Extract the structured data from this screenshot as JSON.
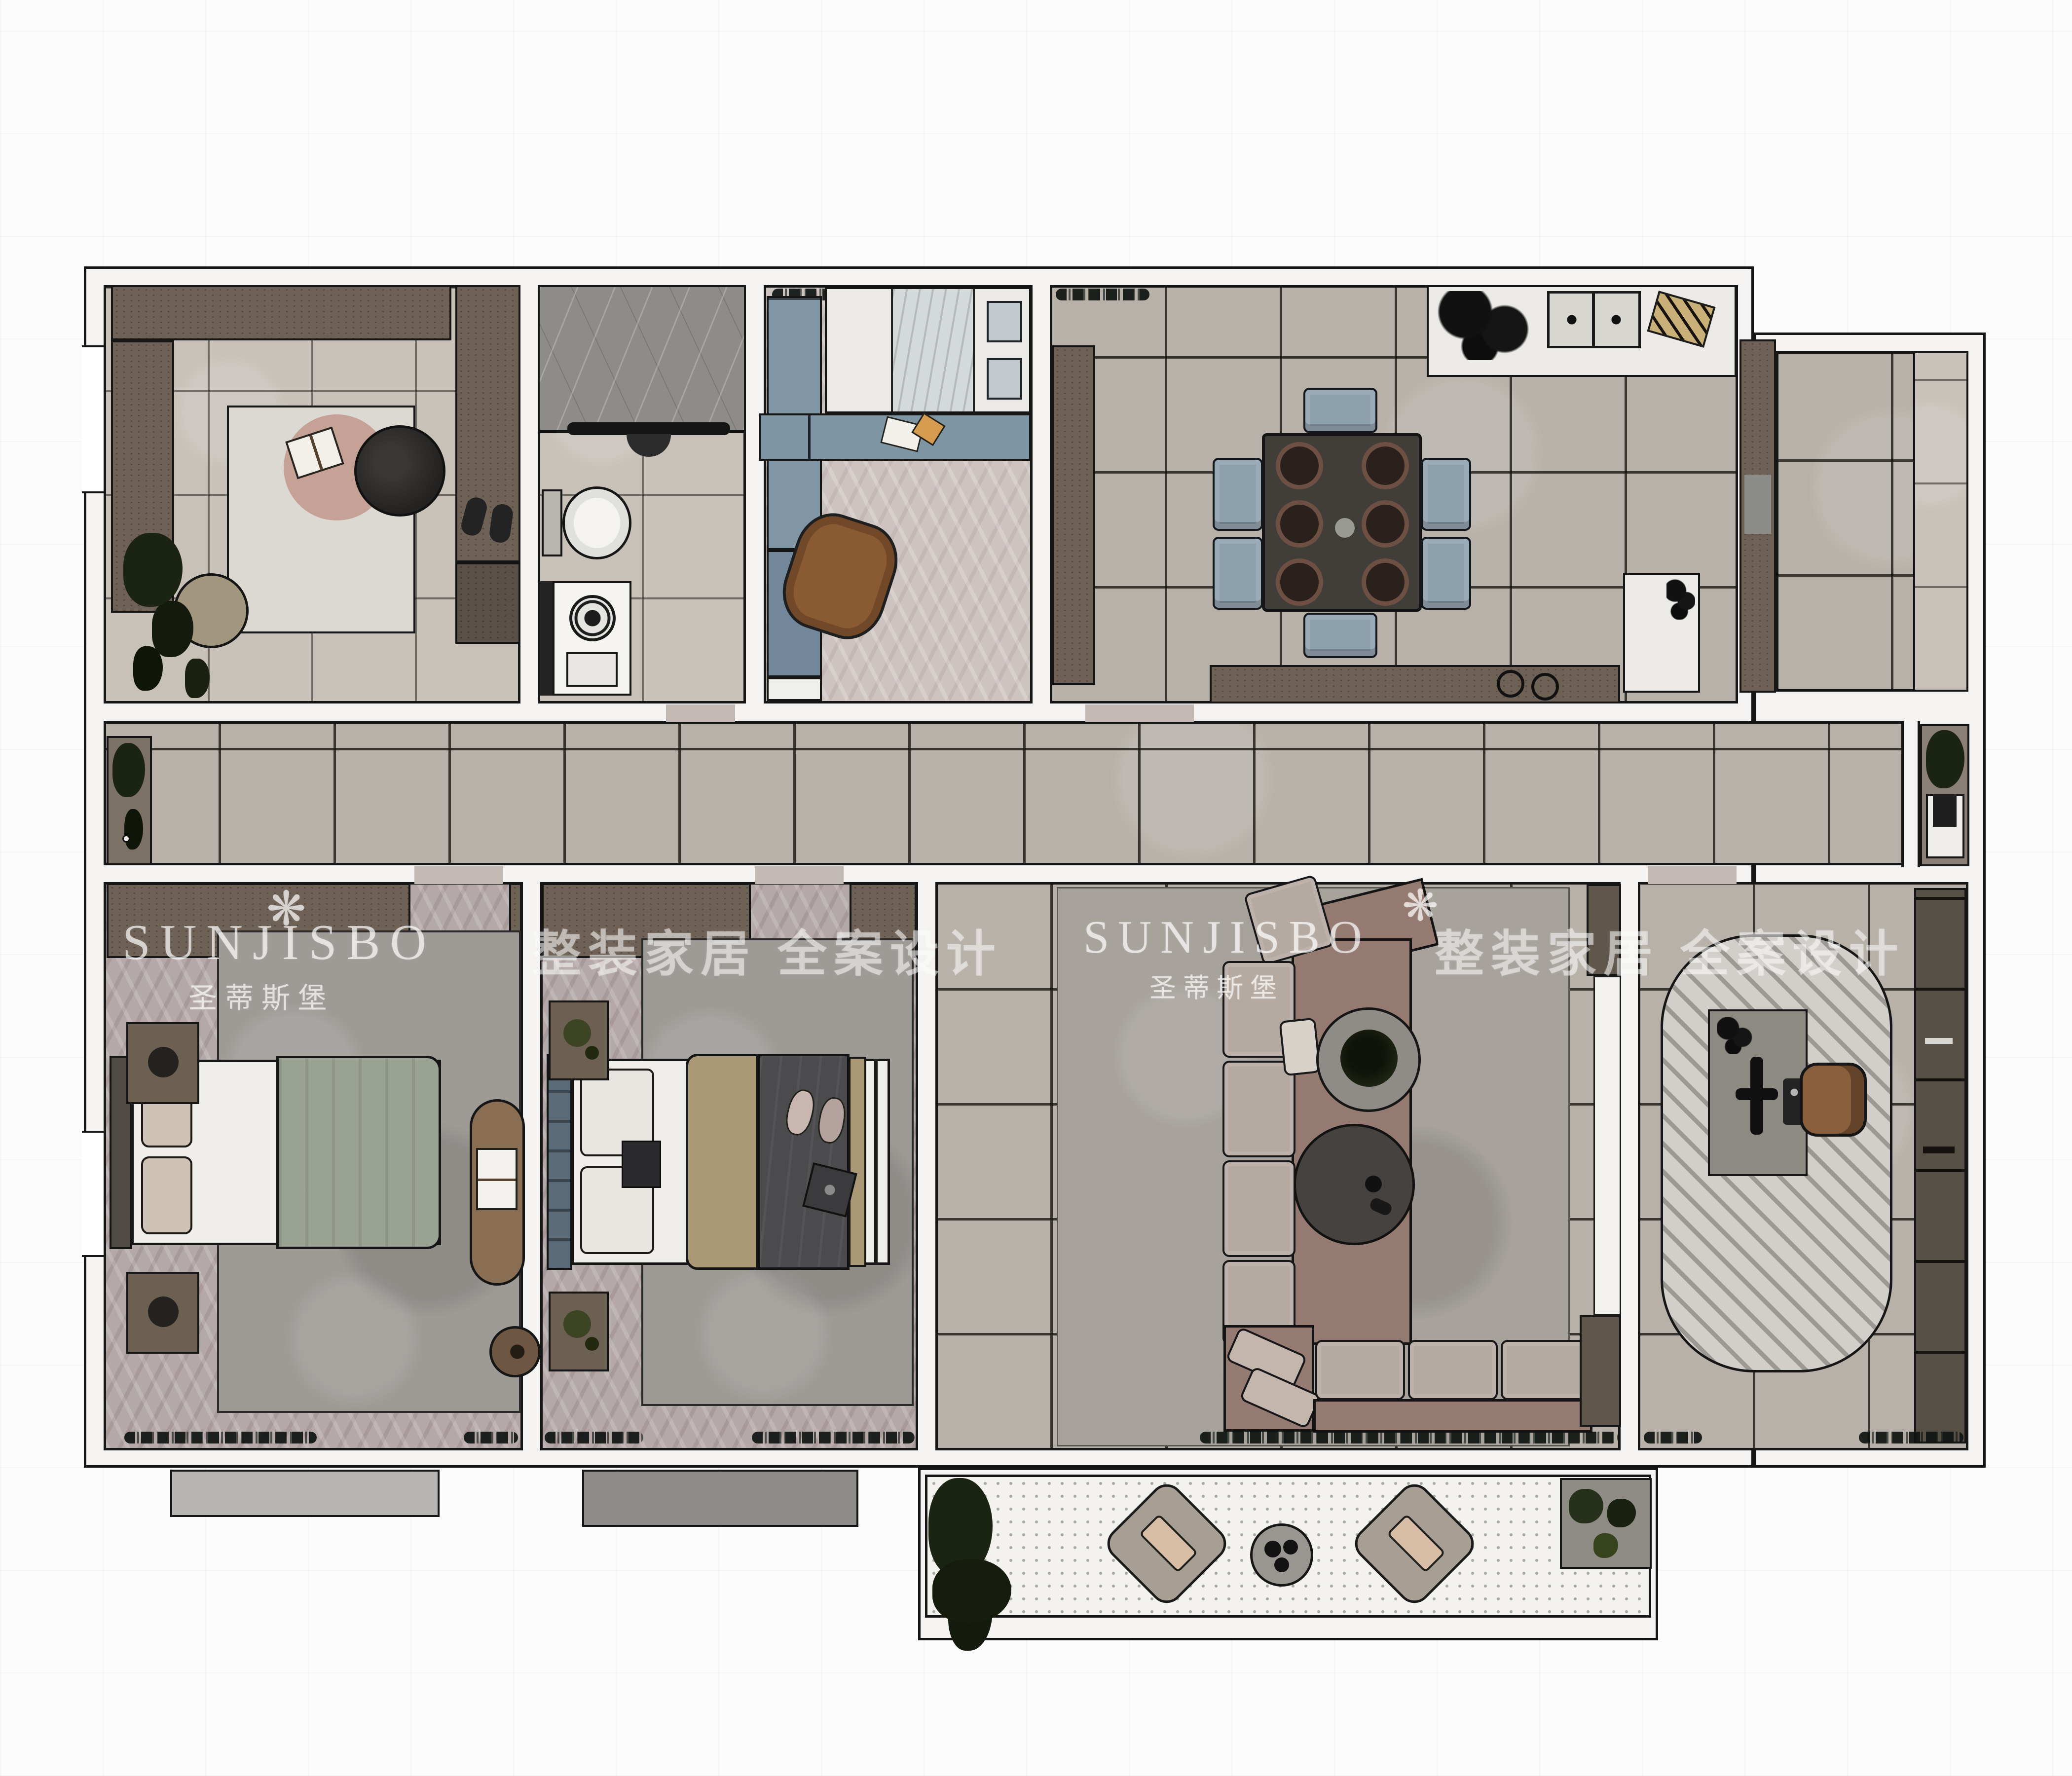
{
  "watermarks": {
    "flower_glyph": "❋",
    "brand": "SUNJISBO",
    "brand_cn": "圣蒂斯堡",
    "slogan_cn": "整装家居 全案设计"
  },
  "colors": {
    "wallLine": "#161616",
    "wallFill": "#f4f3f1",
    "cab": "#6e6156",
    "cabDark": "#57503f",
    "tileBig": "#b7b1a9",
    "herr": "#b3a9a8",
    "herrLight": "#cdc4c1",
    "blue": "#8096a5",
    "blueDesk": "#7e95a4",
    "mauve": "#947a70",
    "cushion": "#b5aaa2",
    "chairBlue": "#8da0ad",
    "dining": "#413d39",
    "rugGray": "#9e9a96",
    "rugLiving": "#a7a29c",
    "studyRug": "#d2cfca",
    "counter": "#eceae6",
    "bedWhite": "#f0eeea",
    "blanketGreen": "#9aa293",
    "blanketTan": "#ab9877",
    "blanketDark": "#4b4b4d",
    "bench": "#8a6e53",
    "bookcase": "#575046",
    "acLight": "#b7b5b1",
    "acDark": "#8e8c89",
    "plantDark": "#1b2313",
    "balconyFloor": "#f3f2ef"
  }
}
